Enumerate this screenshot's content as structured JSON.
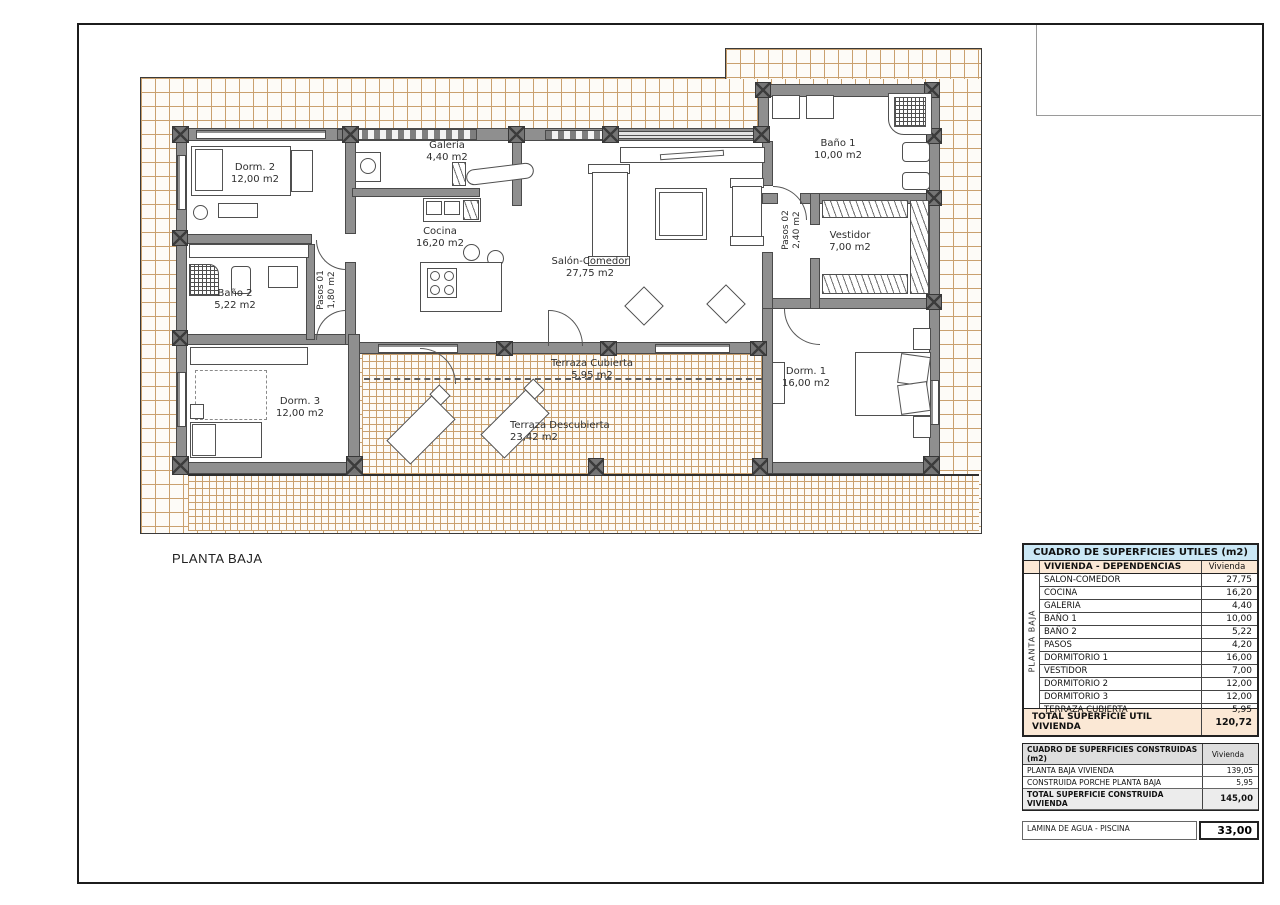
{
  "page": {
    "floor_label": "PLANTA BAJA"
  },
  "plan": {
    "rooms": [
      {
        "name": "Dorm. 2",
        "area": "12,00 m2"
      },
      {
        "name": "Galería",
        "area": "4,40 m2"
      },
      {
        "name": "Cocina",
        "area": "16,20 m2"
      },
      {
        "name": "Salón-Comedor",
        "area": "27,75 m2"
      },
      {
        "name": "Baño 1",
        "area": "10,00 m2"
      },
      {
        "name": "Vestidor",
        "area": "7,00 m2"
      },
      {
        "name": "Baño 2",
        "area": "5,22 m2"
      },
      {
        "name": "Pasos 01",
        "area": "1,80 m2"
      },
      {
        "name": "Pasos 02",
        "area": "2,40 m2"
      },
      {
        "name": "Dorm. 3",
        "area": "12,00 m2"
      },
      {
        "name": "Dorm. 1",
        "area": "16,00 m2"
      },
      {
        "name": "Terraza Cubierta",
        "area": "5,95 m2"
      },
      {
        "name": "Terraza Descubierta",
        "area": "23,42 m2"
      }
    ]
  },
  "tables": {
    "utiles": {
      "title": "CUADRO DE SUPERFICIES UTILES (m2)",
      "group_label": "PLANTA BAJA",
      "col_header": "VIVIENDA - DEPENDENCIAS",
      "value_header": "Vivienda",
      "rows": [
        {
          "label": "SALON-COMEDOR",
          "value": "27,75"
        },
        {
          "label": "COCINA",
          "value": "16,20"
        },
        {
          "label": "GALERIA",
          "value": "4,40"
        },
        {
          "label": "BAÑO 1",
          "value": "10,00"
        },
        {
          "label": "BAÑO 2",
          "value": "5,22"
        },
        {
          "label": "PASOS",
          "value": "4,20"
        },
        {
          "label": "DORMITORIO 1",
          "value": "16,00"
        },
        {
          "label": "VESTIDOR",
          "value": "7,00"
        },
        {
          "label": "DORMITORIO 2",
          "value": "12,00"
        },
        {
          "label": "DORMITORIO 3",
          "value": "12,00"
        },
        {
          "label": "TERRAZA CUBIERTA",
          "value": "5,95"
        }
      ],
      "total_label": "TOTAL SUPERFICIE UTIL VIVIENDA",
      "total_value": "120,72"
    },
    "construidas": {
      "title": "CUADRO DE SUPERFICIES CONSTRUIDAS (m2)",
      "value_header": "Vivienda",
      "rows": [
        {
          "label": "PLANTA BAJA VIVIENDA",
          "value": "139,05"
        },
        {
          "label": "CONSTRUIDA PORCHE PLANTA BAJA",
          "value": "5,95"
        }
      ],
      "total_label": "TOTAL SUPERFICIE CONSTRUIDA VIVIENDA",
      "total_value": "145,00"
    },
    "piscina": {
      "label": "LAMINA DE AGUA - PISCINA",
      "value": "33,00"
    }
  },
  "colors": {
    "table_header_blue": "#cbe8f6",
    "table_peach": "#fbe8d5",
    "grid_line": "#c9a06e",
    "wall_gray": "#8f8f8f"
  }
}
